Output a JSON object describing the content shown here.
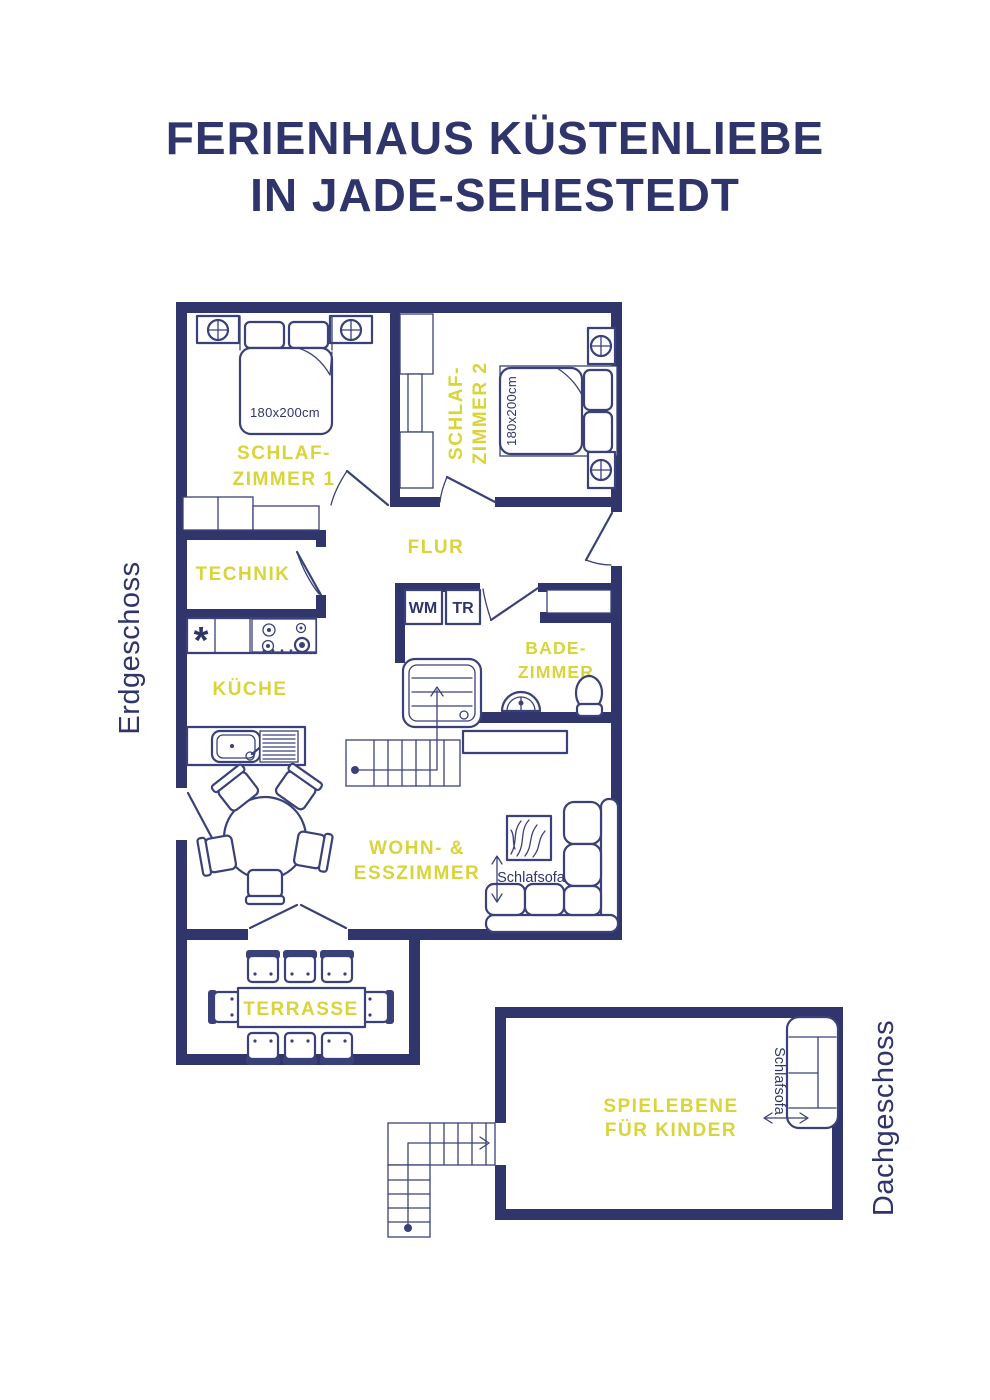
{
  "title": {
    "line1": "FERIENHAUS KÜSTENLIEBE",
    "line2": "IN JADE-SEHESTEDT"
  },
  "floor_labels": {
    "ground": "Erdgeschoss",
    "attic": "Dachgeschoss"
  },
  "rooms": {
    "schlafzimmer1": {
      "label_line1": "SCHLAF-",
      "label_line2": "ZIMMER 1",
      "bed_size": "180x200cm"
    },
    "schlafzimmer2": {
      "label_line1": "SCHLAF-",
      "label_line2": "ZIMMER 2",
      "bed_size": "180x200cm"
    },
    "flur": {
      "label": "FLUR"
    },
    "technik": {
      "label": "TECHNIK"
    },
    "kueche": {
      "label": "KÜCHE",
      "dishwasher_symbol": "*"
    },
    "badezimmer": {
      "label_line1": "BADE-",
      "label_line2": "ZIMMER",
      "washer": "WM",
      "dryer": "TR"
    },
    "wohn_esszimmer": {
      "label_line1": "WOHN- &",
      "label_line2": "ESSZIMMER",
      "sofa_label": "Schlafsofa"
    },
    "terrasse": {
      "label": "TERRASSE"
    },
    "spielebene": {
      "label_line1": "SPIELEBENE",
      "label_line2": "FÜR KINDER",
      "sofa_label": "Schlafsofa"
    }
  },
  "colors": {
    "wall": "#30366b",
    "line": "#3a4178",
    "navy": "#2f356b",
    "accent": "#d8d43a",
    "background": "#ffffff"
  }
}
